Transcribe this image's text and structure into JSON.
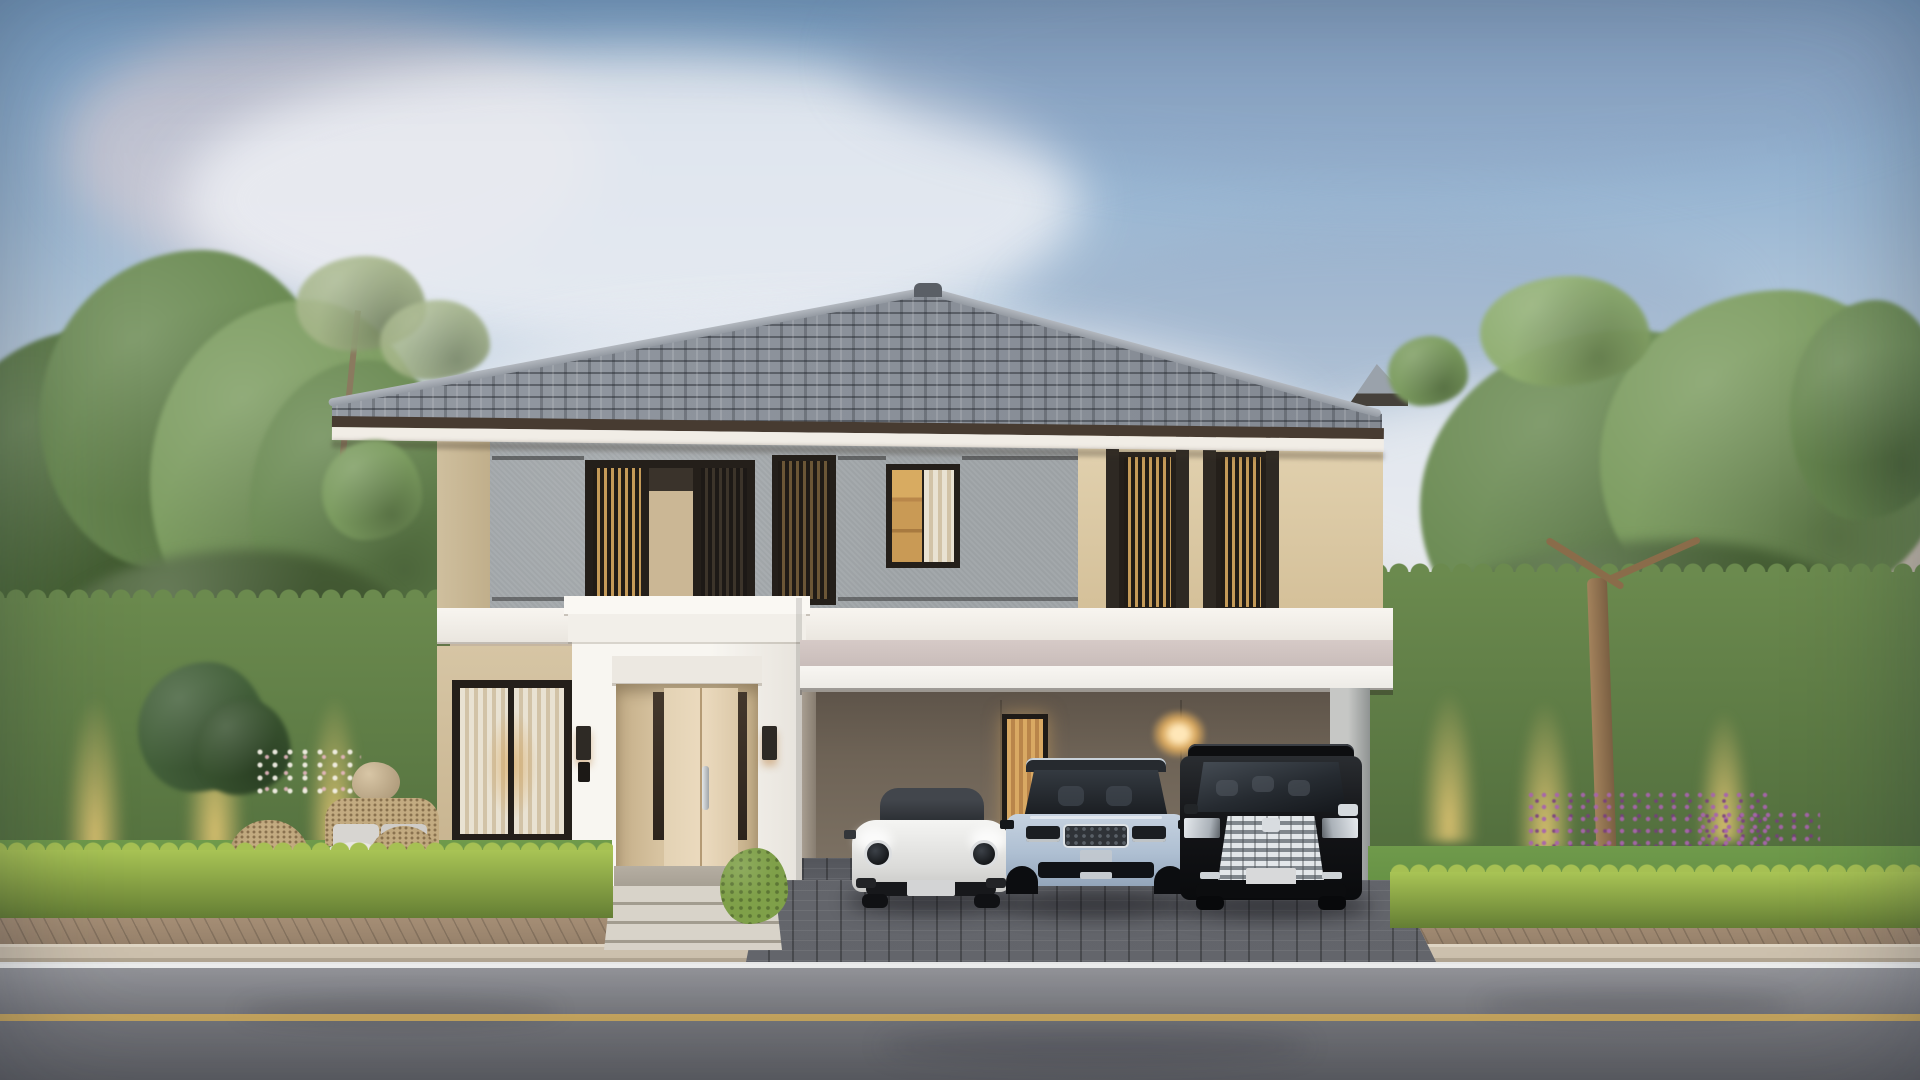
{
  "scene": {
    "description": "Dusk 3D architectural rendering of a modern two-story house with dark timber slatted screens, a white entry portico and a three-car carport, framed by clipped hedges, trees, neighboring houses and a street in the foreground.",
    "time_of_day": "dusk",
    "sky": {
      "label": "dusk sky with soft blue and pink clouds"
    },
    "main_house": {
      "label": "modern two-story house with gray stone and cream stucco facade",
      "roof": "gray hip tile roof with dark fascia",
      "upper_features": [
        "gray textured stone wall",
        "cream stucco wall",
        "dark timber slatted screen windows",
        "curtained window with warm interior light"
      ],
      "ground_features": [
        "white entry portico",
        "cream double entry door",
        "two dark wall sconces",
        "video intercom",
        "curtained living-room window",
        "three-bay carport with taupe interior",
        "narrow curtained carport window",
        "warm carport wall lamp",
        "white carport column"
      ]
    },
    "cars": [
      {
        "label": "white sports coupe with black roof and round headlights",
        "color": "white"
      },
      {
        "label": "silver-blue luxury SUV with mesh grille",
        "color": "silver-blue"
      },
      {
        "label": "black luxury MPV van with large chrome grille",
        "color": "black"
      }
    ],
    "garden": {
      "left": {
        "label": "left garden with rattan lounge set, gray cushions, round table, boulder, tropical plants, white flowers and lit hedge wall"
      },
      "right": {
        "label": "right garden lawn with feature tree, uplit hedge wall and purple flower border"
      },
      "front": {
        "label": "low bright clipped hedge rows along the street"
      }
    },
    "street": {
      "label": "street with brown paver sidewalk, concrete curb, white edge line, yellow center line and dark paver driveway",
      "markings": [
        "white edge line",
        "yellow center line"
      ]
    },
    "neighbors": {
      "left": {
        "label": "beige neighboring house behind trees"
      },
      "right": {
        "label": "greige two-story neighboring house with lit windows"
      }
    }
  },
  "colors": {
    "sky_top": "#7ba2c8",
    "sky_warm": "#f2e6d2",
    "cloud_bright": "#eef0f5",
    "cloud_shadow": "#8fa3c0",
    "cloud_pink": "#e8d3d4",
    "roof_fascia": "#473b31",
    "soffit": "#f1ede6",
    "wall_gray": "#a3a8ab",
    "wall_beige": "#d9c7a3",
    "frame_dark": "#241f1a",
    "window_glow": "#c99a55",
    "white_trim": "#f6f3ee",
    "fascia_mauve": "#d6cac7",
    "carport_wall": "#7c7163",
    "door_cream": "#ead9bd",
    "hedge_dark": "#5f7c45",
    "hedge_bright": "#a6c053",
    "lawn": "#6f9a4b",
    "tree_dark": "#55743f",
    "tree_mid": "#6a8a52",
    "tree_light": "#7c9c60",
    "tree_sage": "#a4b487",
    "sidewalk": "#a5907a",
    "curb": "#cdc1ae",
    "road": "#88898e",
    "road_line_white": "#edeff0",
    "road_line_yellow": "#d9b25a",
    "car_white": "#f0f0ee",
    "car_silver": "#aebfd2",
    "car_black": "#141518",
    "chrome": "#d5dade",
    "wicker": "#c3ab81",
    "cushion": "#d7d5d1"
  }
}
